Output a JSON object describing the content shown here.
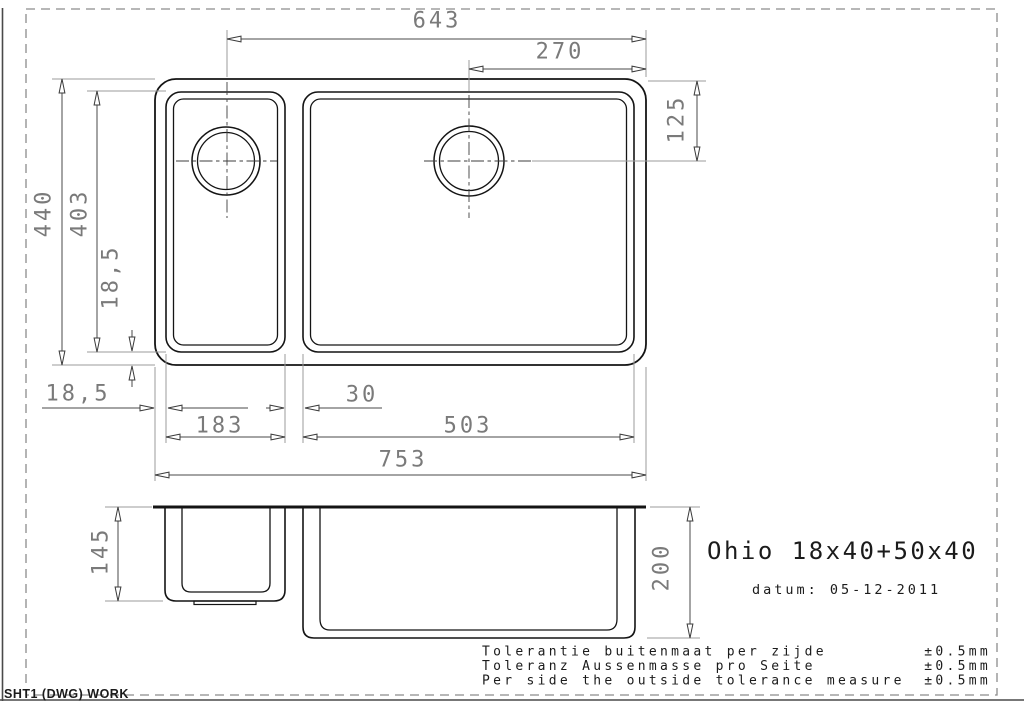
{
  "drawing": {
    "model_name": "Ohio 18x40+50x40",
    "date_line": "datum: 05-12-2011",
    "sheet_label": "SHT1 (DWG) WORK"
  },
  "tolerances": [
    {
      "label": "Tolerantie buitenmaat per zijde",
      "value": "±0.5mm"
    },
    {
      "label": "Toleranz Aussenmasse pro Seite",
      "value": "±0.5mm"
    },
    {
      "label": "Per side the outside tolerance measure",
      "value": "±0.5mm"
    }
  ],
  "dimensions": {
    "drain_left_to_right_edge": "643",
    "drain_right_to_right_edge": "270",
    "drain_right_from_top": "125",
    "overall_depth": "440",
    "bowl_inner_depth": "403",
    "rim_side_left": "18,5",
    "rim_bottom_left": "18,5",
    "small_bowl_width": "183",
    "bowl_gap": "30",
    "large_bowl_width": "503",
    "overall_width": "753",
    "small_bowl_depth": "145",
    "large_bowl_depth": "200"
  },
  "colors": {
    "outline": "#141414",
    "dimension_text": "#7a7a7a",
    "dimension_line": "#4a4a4a",
    "extension_line": "#9b9b9b",
    "border": "#8c8c8c"
  }
}
